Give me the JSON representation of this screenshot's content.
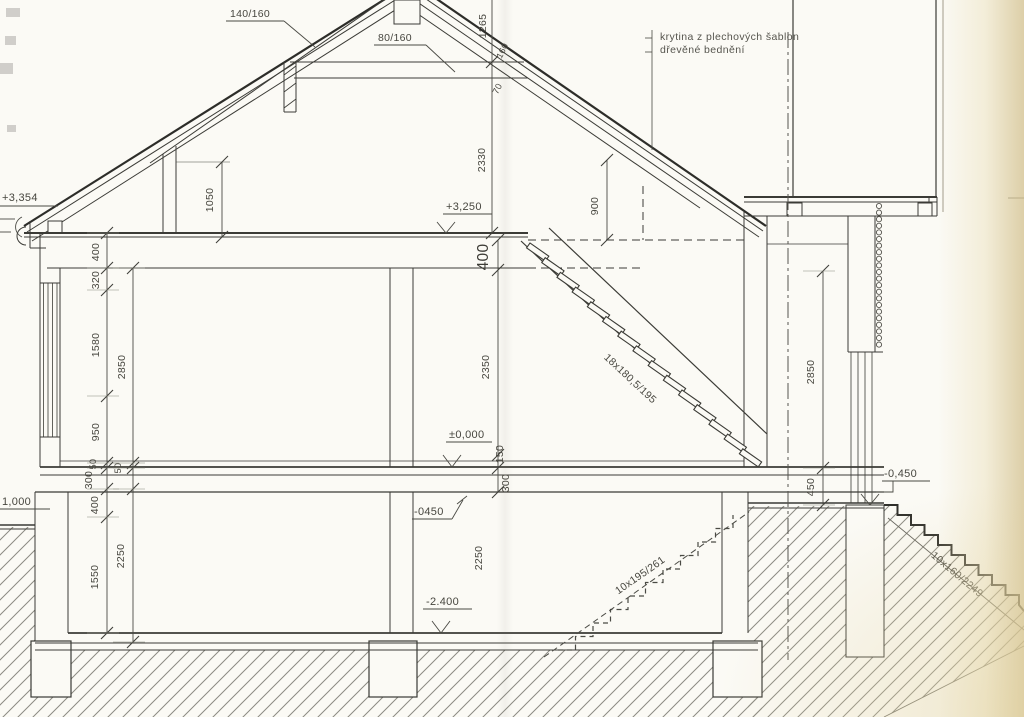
{
  "document": {
    "type": "architectural cross-section drawing",
    "language": "cs"
  },
  "notes": {
    "roof_covering": "krytina z plechových šablon",
    "roof_sheathing": "dřevěné bednění"
  },
  "members": {
    "rafter_size": "140/160",
    "collar_size": "80/160",
    "layer_160": "160",
    "layer_70": "70"
  },
  "stairs": {
    "attic_flight": "18x180,5/195",
    "basement_flight": "10x195/261",
    "exterior_flight": "10x160/2249"
  },
  "levels": {
    "eave": "+3,354",
    "attic_floor": "+3,250",
    "ground_floor": "±0,000",
    "slab_underside": "-0450",
    "basement_floor": "-2.400",
    "terrain_right": "-0,450",
    "terrain_left": "1,000"
  },
  "dims": {
    "ridge_offset": "1265",
    "roof_inner_height": "2330",
    "knee_wall_height": "1050",
    "attic_headroom": "900",
    "attic_slab_thickness": "400",
    "left_400": "400",
    "left_320": "320",
    "left_1580": "1580",
    "left_950": "950",
    "left_total_2850": "2850",
    "left_50_a": "50",
    "left_50_b": "50",
    "bsmt_300": "300",
    "bsmt_400": "400",
    "bsmt_1550": "1550",
    "bsmt_total_2250": "2250",
    "mid_2350": "2350",
    "mid_150": "150",
    "mid_300": "300",
    "right_total_2850": "2850",
    "right_450": "450"
  }
}
